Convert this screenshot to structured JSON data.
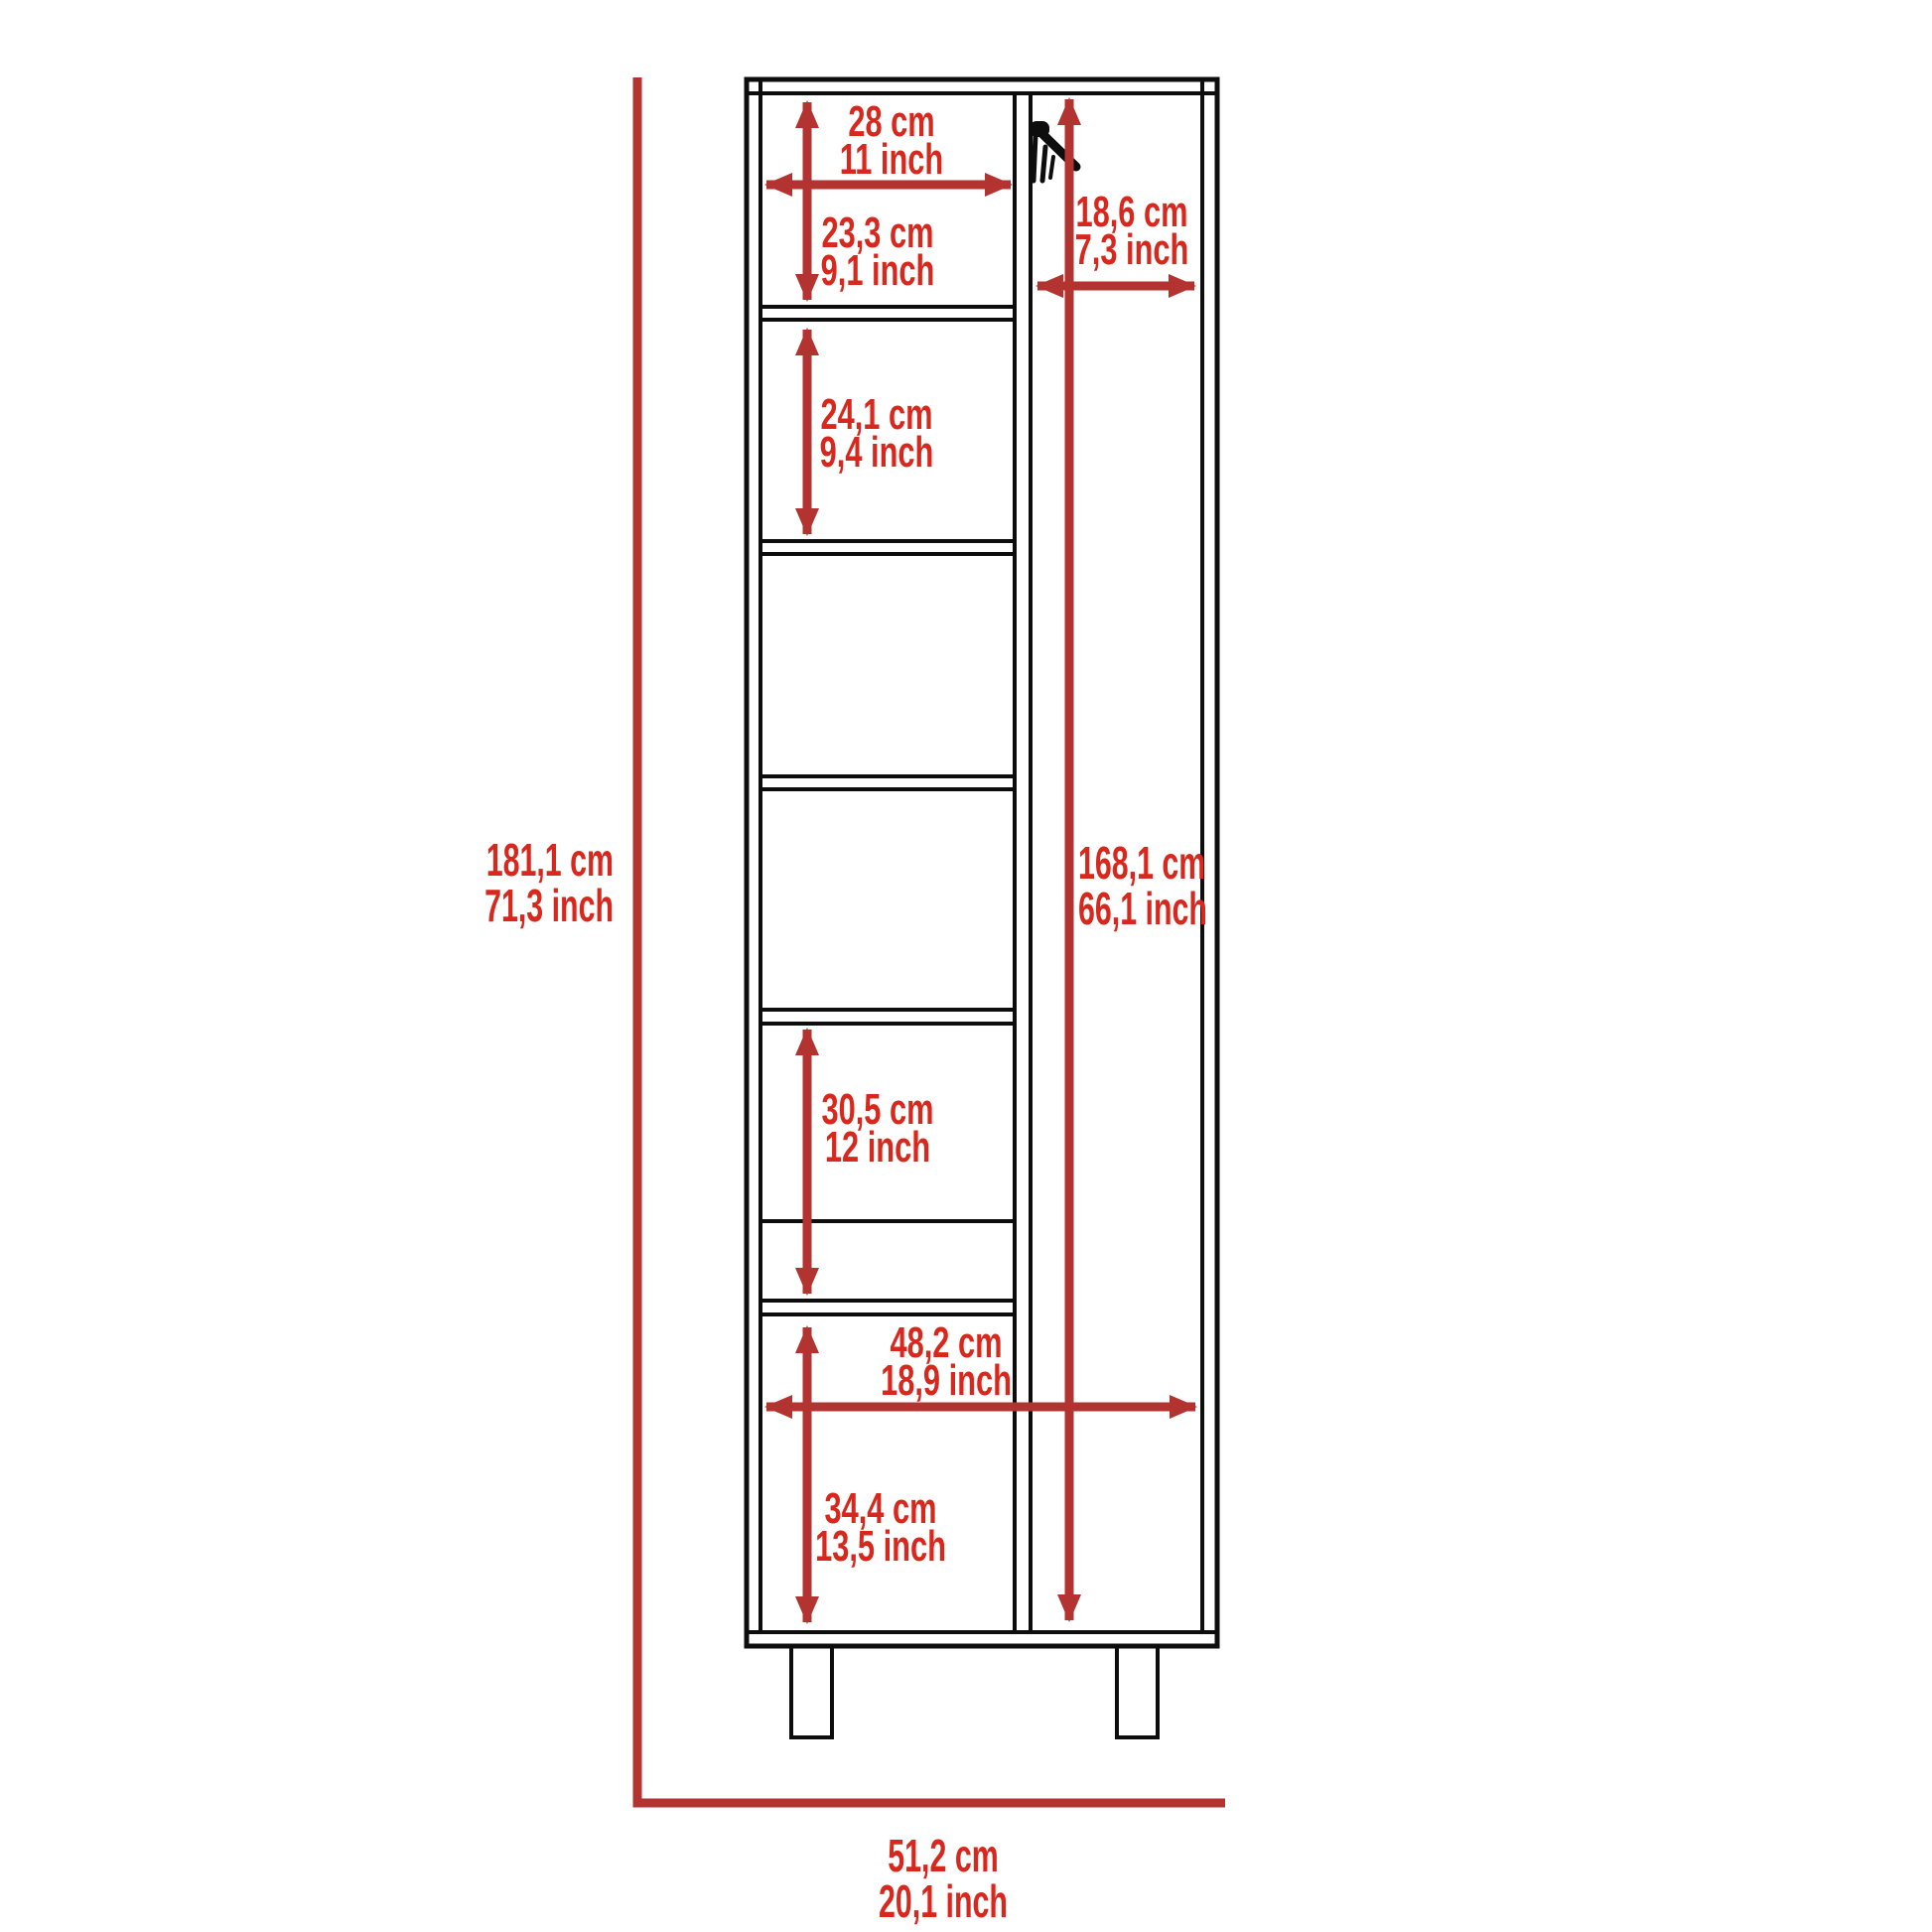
{
  "diagram": {
    "colors": {
      "dimension_text_red": "#d8281d",
      "dimension_line_red": "#b23330",
      "outline_black": "#0d0d0d",
      "background": "#ffffff"
    },
    "dims": {
      "shelf_width": {
        "cm": "28 cm",
        "inch": "11 inch"
      },
      "top_shelf_height": {
        "cm": "23,3 cm",
        "inch": "9,1 inch"
      },
      "door_inner_width": {
        "cm": "18,6 cm",
        "inch": "7,3 inch"
      },
      "second_shelf_height": {
        "cm": "24,1 cm",
        "inch": "9,4 inch"
      },
      "overall_height": {
        "cm": "181,1 cm",
        "inch": "71,3 inch"
      },
      "door_height": {
        "cm": "168,1 cm",
        "inch": "66,1 inch"
      },
      "lower_shelf_height": {
        "cm": "30,5 cm",
        "inch": "12 inch"
      },
      "bottom_inner_width": {
        "cm": "48,2 cm",
        "inch": "18,9 inch"
      },
      "bottom_door_height": {
        "cm": "34,4 cm",
        "inch": "13,5 inch"
      },
      "overall_width": {
        "cm": "51,2 cm",
        "inch": "20,1 inch"
      }
    }
  }
}
